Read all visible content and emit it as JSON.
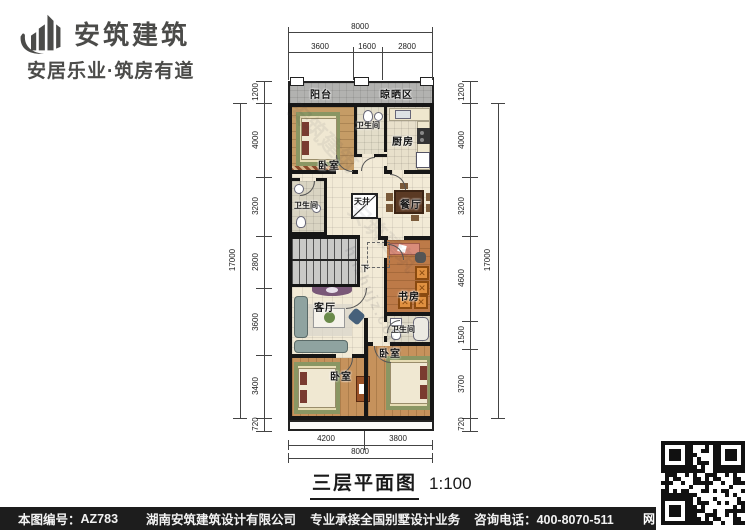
{
  "brand": {
    "name": "安筑建筑",
    "tagline": "安居乐业·筑房有道"
  },
  "drawing": {
    "title": "三层平面图",
    "scale": "1:100"
  },
  "rooms": {
    "balcony": "阳台",
    "drying_area": "晾晒区",
    "bedroom_top": "卧室",
    "bath_top": "卫生间",
    "kitchen": "厨房",
    "bath_mid": "卫生间",
    "lightwell": "天井",
    "dining": "餐厅",
    "stairs_down": "下",
    "study": "书房",
    "living": "客厅",
    "bath_low": "卫生间",
    "bedroom_right": "卧室",
    "bedroom_left": "卧室"
  },
  "dimensions": {
    "top": {
      "total": "8000",
      "segments": [
        "3600",
        "1600",
        "2800"
      ]
    },
    "bottom": {
      "total": "8000",
      "segments": [
        "4200",
        "3800"
      ]
    },
    "left": {
      "total": "17000",
      "segments": [
        "1200",
        "4000",
        "3200",
        "2800",
        "3600",
        "3400",
        "720"
      ]
    },
    "right": {
      "total": "17000",
      "segments": [
        "1200",
        "4000",
        "3200",
        "4600",
        "1500",
        "3700",
        "720"
      ]
    }
  },
  "watermark": {
    "brand": "安筑建筑",
    "site": "hnzhujz.com"
  },
  "footer": {
    "number_label": "本图编号：",
    "number": "AZ783",
    "company": "湖南安筑建筑设计有限公司",
    "service": "专业承接全国别墅设计业务",
    "phone": "咨询电话：400-8070-511",
    "web": "网"
  }
}
